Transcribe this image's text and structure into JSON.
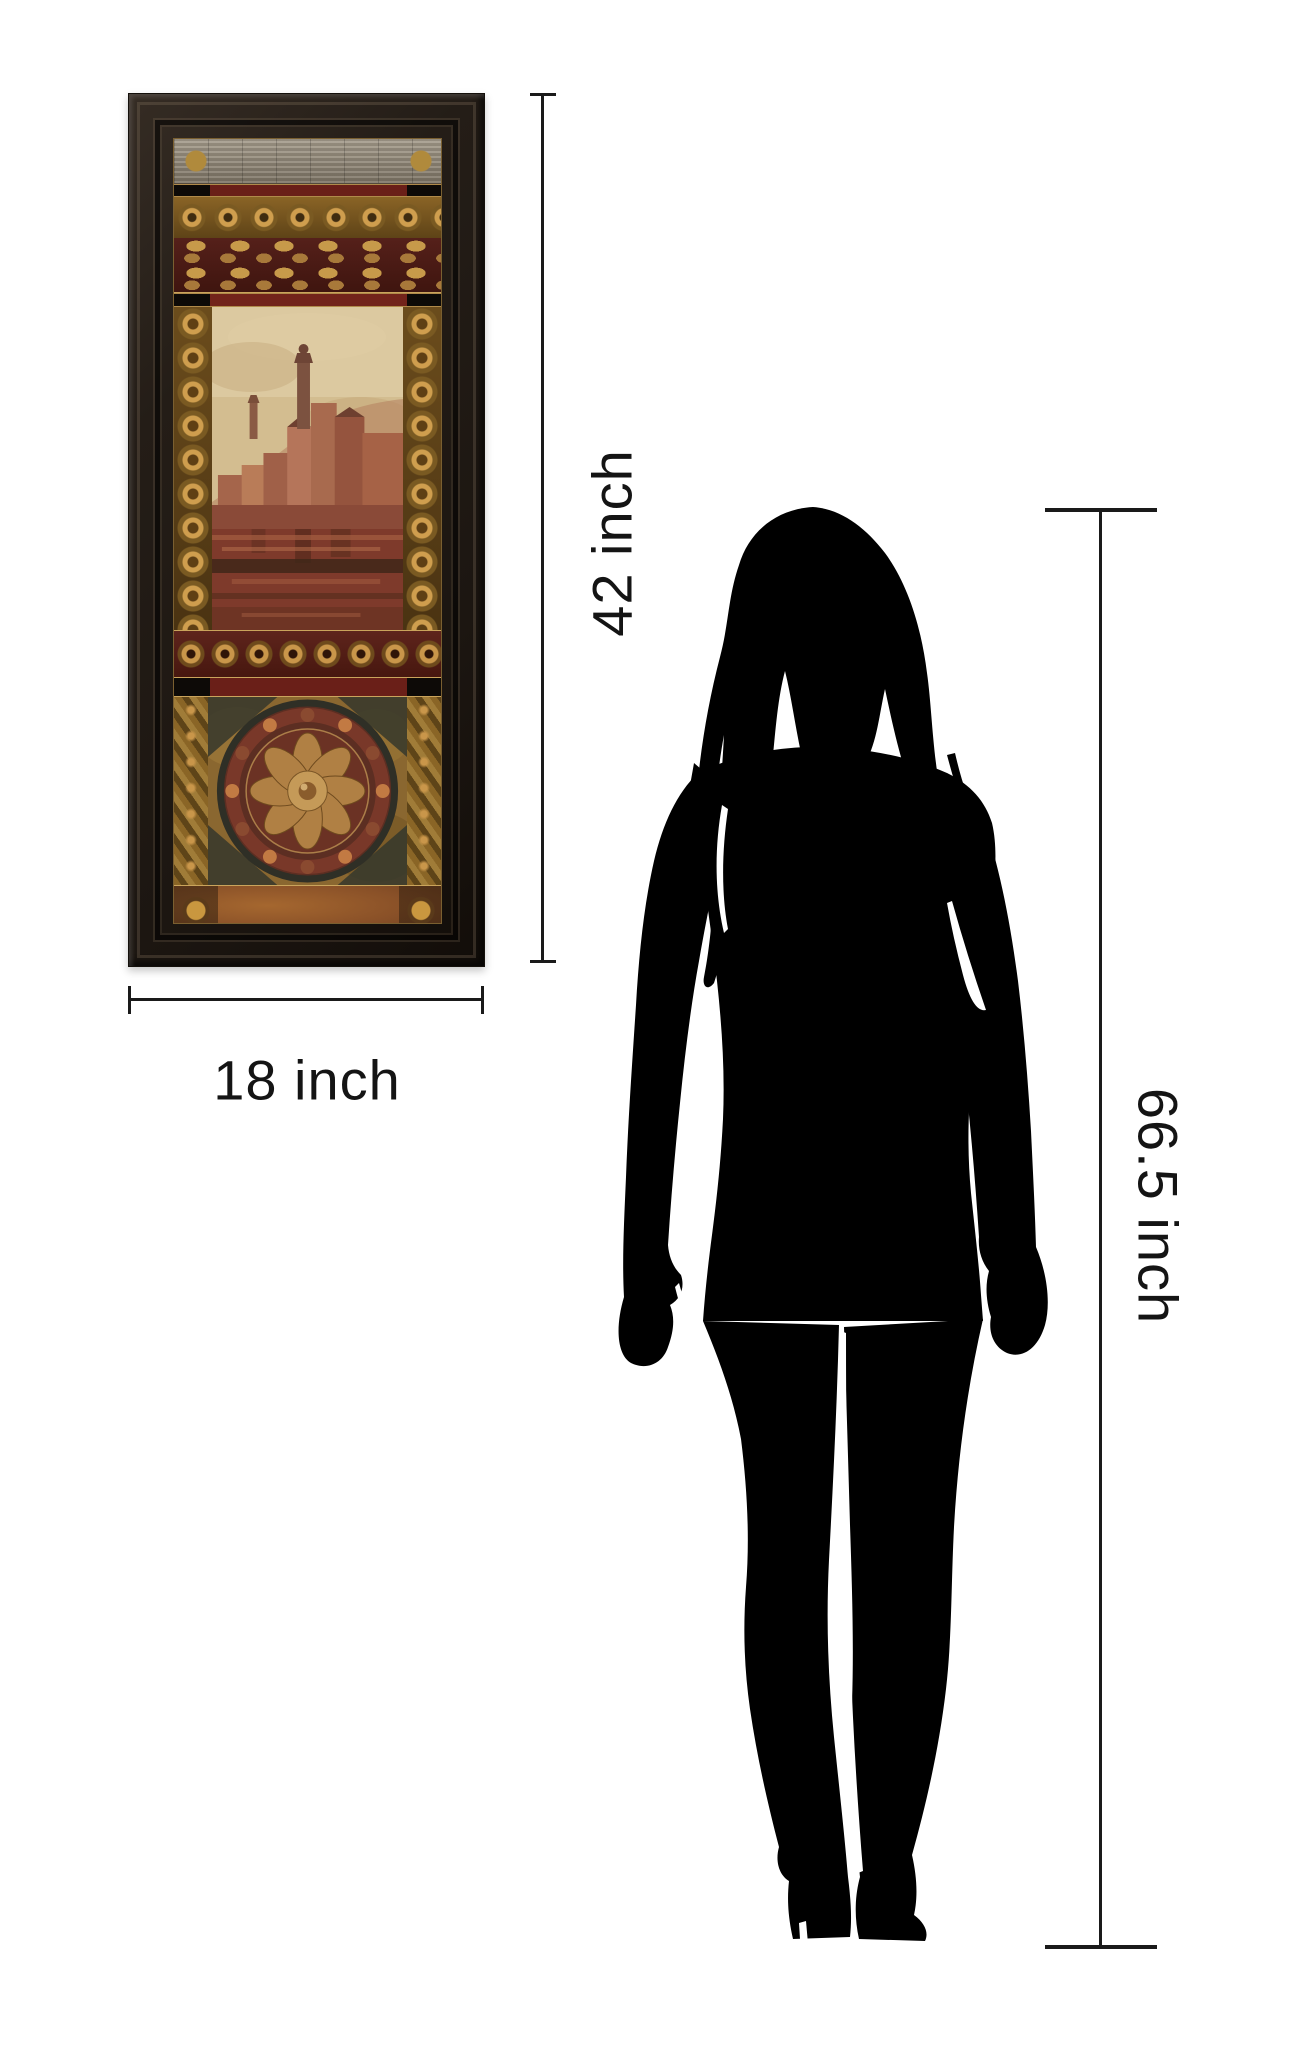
{
  "page": {
    "background_color": "#ffffff",
    "description": "Product size comparison: framed art print next to woman silhouette"
  },
  "artwork": {
    "item": "framed-art-print",
    "height_label": "42 inch",
    "width_label": "18 inch",
    "frame_color": "#241d17",
    "accent_gold": "#c49a4e",
    "accent_maroon": "#5e1f19",
    "accent_silver": "#9a9183",
    "scene": "hillside town with bell tower above red-gold water",
    "medallion": "circular floral rosette"
  },
  "person": {
    "item": "woman-silhouette",
    "height_label": "66.5 inch",
    "silhouette_color": "#000000"
  },
  "dimensions": {
    "line_color": "#1a1a1a"
  }
}
